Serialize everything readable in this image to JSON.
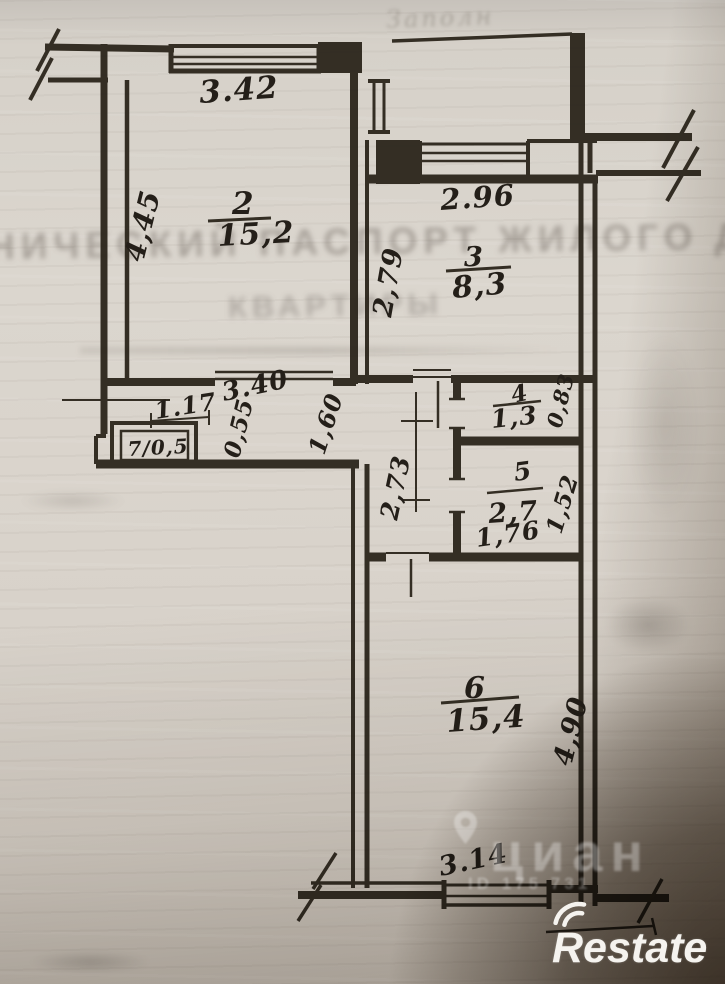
{
  "floor_plan": {
    "rooms": [
      {
        "number": "2",
        "area": "15,2"
      },
      {
        "number": "3",
        "area": "8,3"
      },
      {
        "number": "4",
        "area": "1,3"
      },
      {
        "number": "5",
        "area": "2,7"
      },
      {
        "number": "6",
        "area": "15,4"
      },
      {
        "number": "7",
        "area_label": "7/0,5"
      }
    ],
    "dimensions": {
      "room2_width_top": "3.42",
      "room2_height_left": "4,45",
      "room3_width_top": "2.96",
      "room3_height_left": "2,79",
      "hallway_width": "3.40",
      "hallway_niche_width": "1.17",
      "hallway_niche_depth": "0,55",
      "hallway_passage": "1,60",
      "room4_height": "0,83",
      "room5_width": "1,76",
      "room5_height": "1,52",
      "hallway_lower_height": "2,73",
      "room6_height_right": "4,90",
      "room6_width_bottom": "3.14"
    }
  },
  "bleed_through": {
    "line1": "НИЧЕСКИЙ ПАСПОРТ ЖИЛОГО ДОМ",
    "line2": "КВАРТИРЫ",
    "handwriting_top": "Заполн"
  },
  "watermarks": {
    "cian": "циан",
    "cian_id": "ID 175 731",
    "restate": "Restate"
  }
}
